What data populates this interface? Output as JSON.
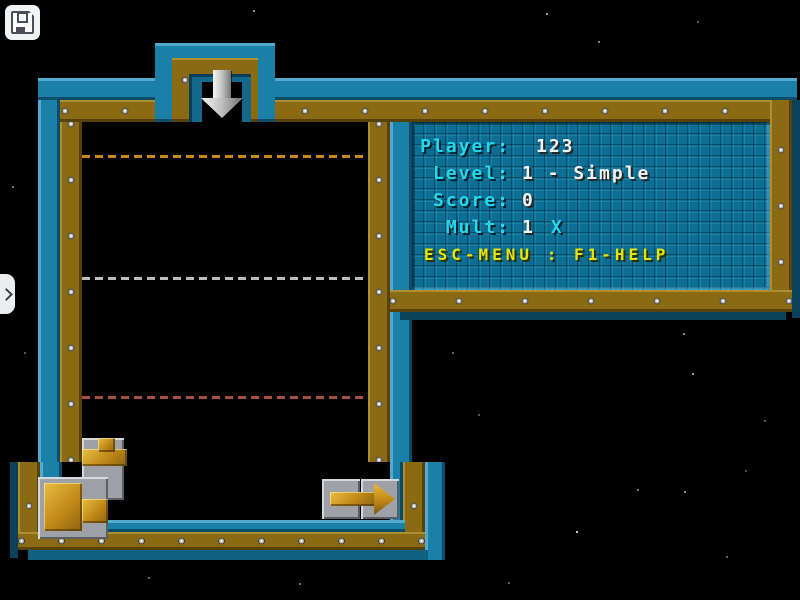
{
  "overlay": {
    "save_button": {
      "icon": "floppy-disk"
    },
    "drawer_tab": {
      "icon": "chevron-right"
    }
  },
  "hud": {
    "rows": [
      {
        "label": "Player:",
        "value": "123",
        "suffix": ""
      },
      {
        "label": "Level:",
        "value": "1 - Simple",
        "suffix": ""
      },
      {
        "label": "Score:",
        "value": "0",
        "suffix": ""
      },
      {
        "label": "Mult:",
        "value": "1",
        "suffix": "X"
      }
    ],
    "help": "ESC-MENU : F1-HELP"
  },
  "board": {
    "entry_arrow_icon": "down-arrow",
    "exit_arrow_icon": "right-arrow",
    "placed_pieces": [
      "tee-pipe",
      "elbow-pipe",
      "exit-arrow"
    ],
    "guide_lines": [
      {
        "row": 1,
        "color": "#C8881C"
      },
      {
        "row": 2,
        "color": "#BDBDBD"
      },
      {
        "row": 3,
        "color": "#A85048"
      }
    ]
  },
  "colors": {
    "wall_teal": "#1B80A8",
    "wall_gold": "#8A6A12",
    "panel_teal": "#0C6E92",
    "hud_label_cyan": "#26D7EC",
    "hud_value_white": "#F2F2F2",
    "hud_help_yellow": "#E6E600",
    "pipe_gold": "#C08818",
    "tile_gray": "#9FA1A9",
    "background": "#000000"
  }
}
